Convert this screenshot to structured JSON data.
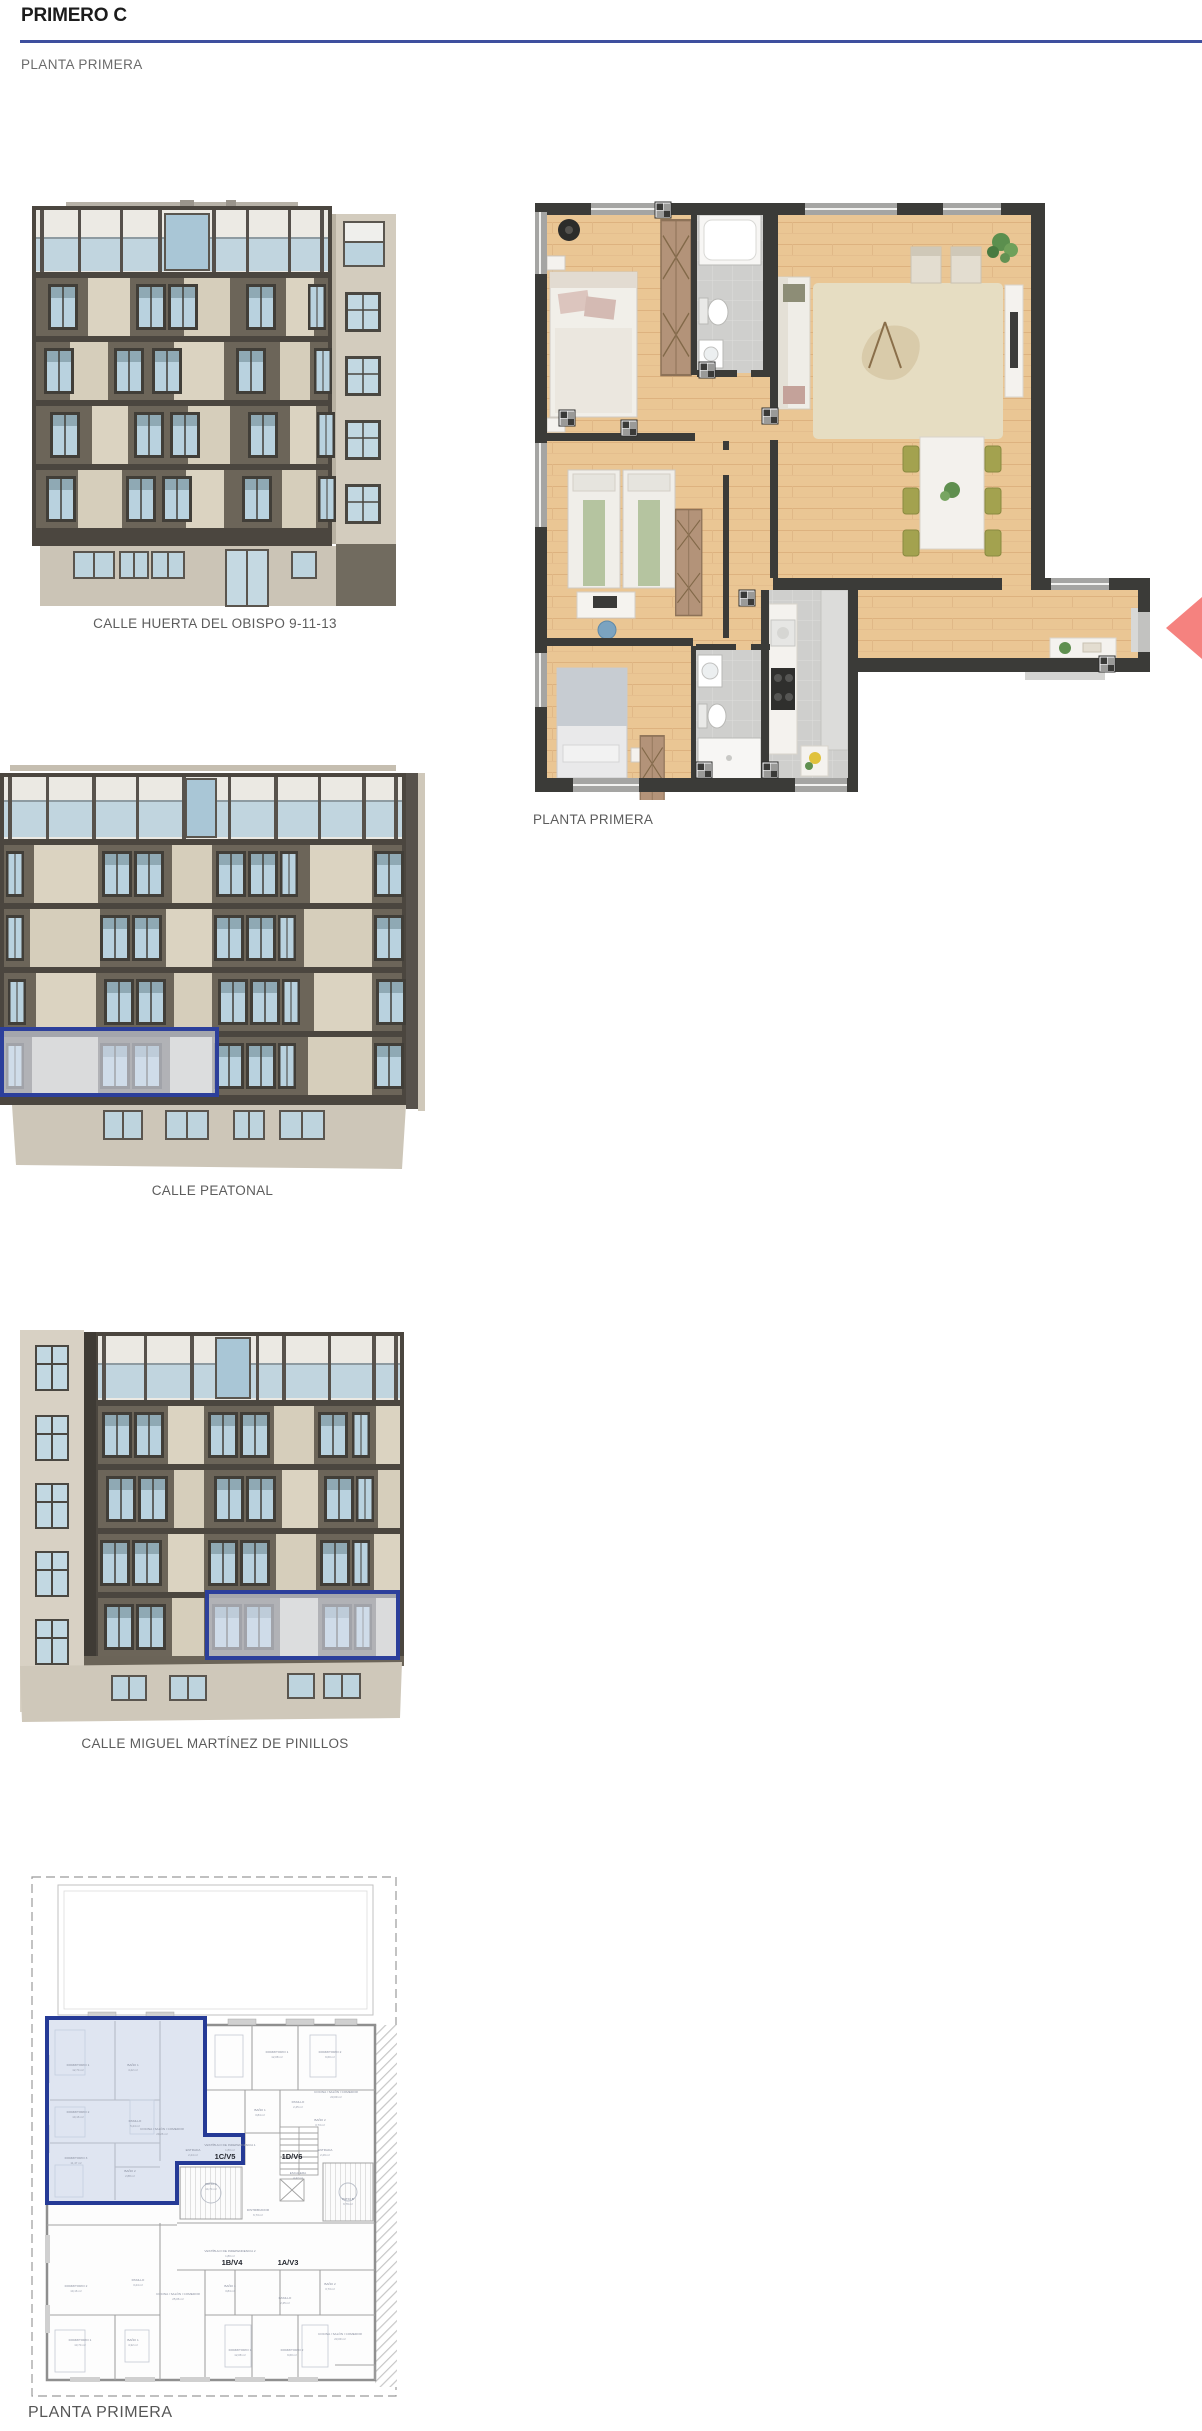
{
  "page": {
    "title": "PRIMERO C",
    "subtitle": "PLANTA PRIMERA"
  },
  "colors": {
    "accent": "#3e4f9e",
    "highlight_outline": "#2c3f9b",
    "marker": "#f5827f"
  },
  "figures": {
    "elevation_obispo": {
      "caption": "CALLE HUERTA DEL OBISPO 9-11-13"
    },
    "floorplan_render": {
      "caption": "PLANTA PRIMERA"
    },
    "elevation_peatonal": {
      "caption": "CALLE PEATONAL"
    },
    "elevation_pinillos": {
      "caption": "CALLE MIGUEL MARTÍNEZ DE PINILLOS"
    },
    "schematic": {
      "caption": "PLANTA PRIMERA",
      "units": [
        {
          "id": "1C/V5"
        },
        {
          "id": "1D/V6"
        },
        {
          "id": "1B/V4"
        },
        {
          "id": "1A/V3"
        }
      ],
      "rooms": [
        {
          "n": "DORMITORIO 1",
          "a": "12,74 m²"
        },
        {
          "n": "BAÑO 1",
          "a": "4,22 m²"
        },
        {
          "n": "DORMITORIO 2",
          "a": "10,16 m²"
        },
        {
          "n": "PASILLO",
          "a": "5,24 m²"
        },
        {
          "n": "COCINA / SALÓN / COMEDOR",
          "a": "29,26 m²"
        },
        {
          "n": "DORMITORIO 3",
          "a": "11,47 m²"
        },
        {
          "n": "BAÑO 2",
          "a": "2,88 m²"
        },
        {
          "n": "ENTRADA",
          "a": "2,24 m²"
        },
        {
          "n": "DORMITORIO 1",
          "a": "12,08 m²"
        },
        {
          "n": "DORMITORIO 2",
          "a": "9,60 m²"
        },
        {
          "n": "BAÑO 1",
          "a": "3,84 m²"
        },
        {
          "n": "PASILLO",
          "a": "2,45 m²"
        },
        {
          "n": "BAÑO 2",
          "a": "3,73 m²"
        },
        {
          "n": "COCINA / SALÓN / COMEDOR",
          "a": "23,09 m²"
        },
        {
          "n": "ENTRADA",
          "a": "2,29 m²"
        },
        {
          "n": "PATIO A",
          "a": "14,74 m²"
        },
        {
          "n": "DISTRIBUIDOR",
          "a": "6,73 m²"
        },
        {
          "n": "ESCALERA",
          "a": "4,42 m²"
        },
        {
          "n": "PATIO B",
          "a": "9,79 m²"
        },
        {
          "n": "VESTÍBULO DE INDEPENDENCIA 1",
          "a": "1,80 m²"
        },
        {
          "n": "VESTÍBULO DE INDEPENDENCIA 2",
          "a": "1,80 m²"
        },
        {
          "n": "DORMITORIO 2",
          "a": "10,16 m²"
        },
        {
          "n": "DORMITORIO 1",
          "a": "13,74 m²"
        },
        {
          "n": "BAÑO 1",
          "a": "4,32 m²"
        },
        {
          "n": "PASILLO",
          "a": "3,24 m²"
        },
        {
          "n": "COCINA / SALÓN / COMEDOR",
          "a": "25,06 m²"
        },
        {
          "n": "BAÑO 1",
          "a": "3,84 m²"
        },
        {
          "n": "DORMITORIO 1",
          "a": "12,08 m²"
        },
        {
          "n": "DORMITORIO 2",
          "a": "9,60 m²"
        },
        {
          "n": "BAÑO 2",
          "a": "3,73 m²"
        },
        {
          "n": "PASILLO",
          "a": "2,45 m²"
        },
        {
          "n": "COCINA / SALÓN / COMEDOR",
          "a": "23,09 m²"
        }
      ]
    }
  }
}
